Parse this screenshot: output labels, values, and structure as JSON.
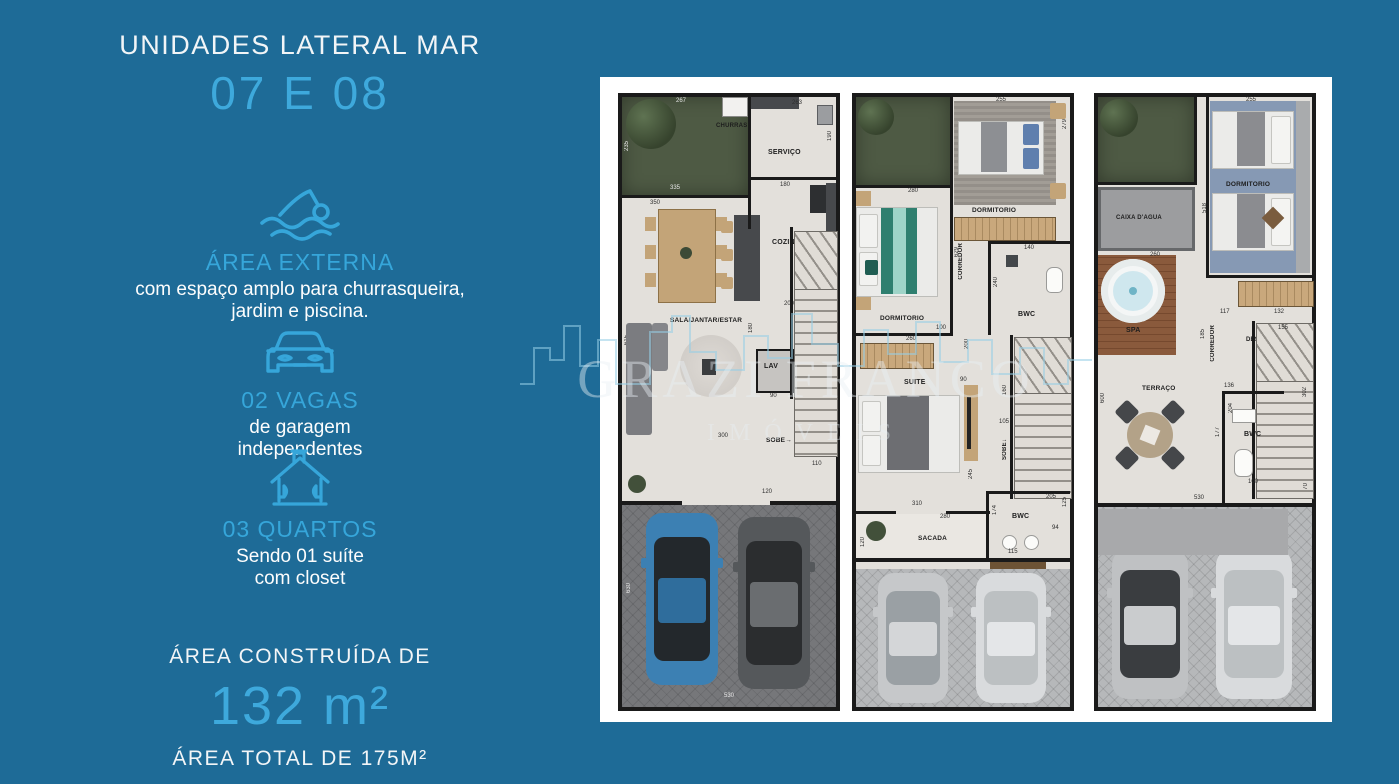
{
  "colors": {
    "background": "#1e6b97",
    "accent_blue": "#36a6da",
    "card_white": "#ffffff",
    "wall_black": "#1a1a1a",
    "floor": "#e3e0db",
    "grass_green": "#4e5a44",
    "car_blue": "#3c80b3",
    "car_dark_gray": "#55585b",
    "car_silver": "#c6c8ca"
  },
  "sidebar": {
    "title": "UNIDADES LATERAL  MAR",
    "units": "07 E 08",
    "features": [
      {
        "heading": "ÁREA EXTERNA",
        "line1": "com espaço amplo para churrasqueira,",
        "line2": "jardim e piscina."
      },
      {
        "heading": "02 VAGAS",
        "line1": "de garagem",
        "line2": "independentes"
      },
      {
        "heading": "03 QUARTOS",
        "line1": "Sendo 01 suíte",
        "line2": "com closet"
      }
    ],
    "built_area_label": "ÁREA CONSTRUÍDA DE",
    "built_area_value": "132 m²",
    "total_area": "ÁREA TOTAL DE 175M²"
  },
  "watermark": {
    "name": "GRAZI FRANCO",
    "subtitle": "IMÓVEIS"
  },
  "floorplans": {
    "plan1": {
      "rooms": {
        "churras": "CHURRAS",
        "servico": "SERVIÇO",
        "cozinha": "COZINHA",
        "sala": "SALA/JANTAR/ESTAR",
        "lav": "LAV",
        "sobe": "SOBE"
      },
      "dims": {
        "g_w": "267",
        "g_h": "235",
        "g_b": "335",
        "sv_w": "263",
        "sv_h": "190",
        "cz_w": "180",
        "cz_h": "334",
        "cz_b": "200",
        "sl_w": "350",
        "sl_h": "615",
        "lv_h": "180",
        "lv_w": "90",
        "hall": "300",
        "st": "110",
        "entry": "120",
        "gar_h": "630",
        "gar_w": "530"
      }
    },
    "plan2": {
      "rooms": {
        "dorm1": "DORMITORIO",
        "bwc1": "BWC",
        "dorm2": "DORMITORIO",
        "corredor": "CORREDOR",
        "suite": "SUITE",
        "sobe": "SOBE",
        "bwc2": "BWC",
        "sacada": "SACADA"
      },
      "dims": {
        "d255": "255",
        "d279": "279",
        "d629": "629",
        "d280": "280",
        "d308": "308",
        "d140": "140",
        "d240": "240",
        "d100": "100",
        "d200": "200",
        "d260": "260",
        "d90": "90",
        "d245": "245",
        "d160": "160",
        "d105": "105",
        "d310": "310",
        "d280b": "280",
        "d120": "120",
        "d174": "174",
        "d205": "205",
        "d94": "94",
        "d125": "125",
        "d115": "115"
      }
    },
    "plan3": {
      "rooms": {
        "caixa": "CAIXA D'AGUA",
        "spa": "SPA",
        "dorm": "DORMITORIO",
        "corredor": "CORREDOR",
        "desce": "DESCE",
        "bwc": "BWC",
        "terraco": "TERRAÇO"
      },
      "dims": {
        "d255": "255",
        "d518": "518",
        "d260": "260",
        "d117": "117",
        "d132": "132",
        "d185": "185",
        "d136": "136",
        "d155": "155",
        "d302": "302",
        "d204": "204",
        "d177": "177",
        "d100": "100",
        "d600": "600",
        "d530": "530",
        "d70": "70"
      }
    }
  }
}
